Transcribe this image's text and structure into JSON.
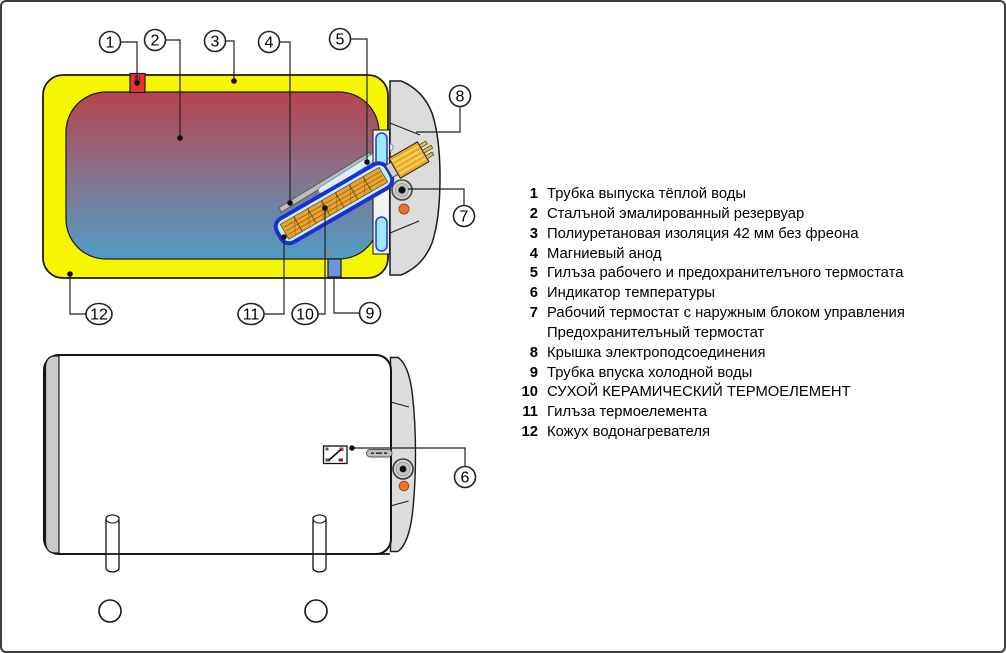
{
  "callouts": {
    "c1": "1",
    "c2": "2",
    "c3": "3",
    "c4": "4",
    "c5": "5",
    "c6": "6",
    "c7": "7",
    "c8": "8",
    "c9": "9",
    "c10": "10",
    "c11": "11",
    "c12": "12"
  },
  "legend": {
    "items": [
      {
        "num": "1",
        "text": "Трубка выпуска тёплой воды"
      },
      {
        "num": "2",
        "text": "Сталъной эмалированный резервуар"
      },
      {
        "num": "3",
        "text": "Полиуретановая изоляция 42 мм без фреона"
      },
      {
        "num": "4",
        "text": "Магниевый анод"
      },
      {
        "num": "5",
        "text": "Гилъза рабочего и предохранителъного термостата"
      },
      {
        "num": "6",
        "text": "Индикатор температуры"
      },
      {
        "num": "7",
        "text": "Рабочий термостат с наружным блоком управления"
      },
      {
        "num": "",
        "text": "Предохранителъный термостат"
      },
      {
        "num": "8",
        "text": "Крышка электроподсоединения"
      },
      {
        "num": "9",
        "text": "Трубка впуска холодной воды"
      },
      {
        "num": "10",
        "text": "СУХОЙ КЕРАМИЧЕСКИЙ ТЕРМОЕЛЕМЕНТ"
      },
      {
        "num": "11",
        "text": "Гилъза термоелемента"
      },
      {
        "num": "12",
        "text": "Кожух водонагревателя"
      }
    ]
  },
  "colors": {
    "insulation_yellow": "#f6f600",
    "tank_hot_red": "#b5434e",
    "tank_mid": "#8d6e86",
    "tank_cold_blue": "#4f9dc6",
    "sleeve_blue": "#1c2ed6",
    "sleeve_cyan": "#bfeffb",
    "element_orange": "#eba232",
    "hot_pipe_red": "#e63239",
    "cold_pipe_blue": "#6d95dd",
    "cap_gray": "#dcdcdc",
    "indicator_orange": "#f06f28"
  }
}
